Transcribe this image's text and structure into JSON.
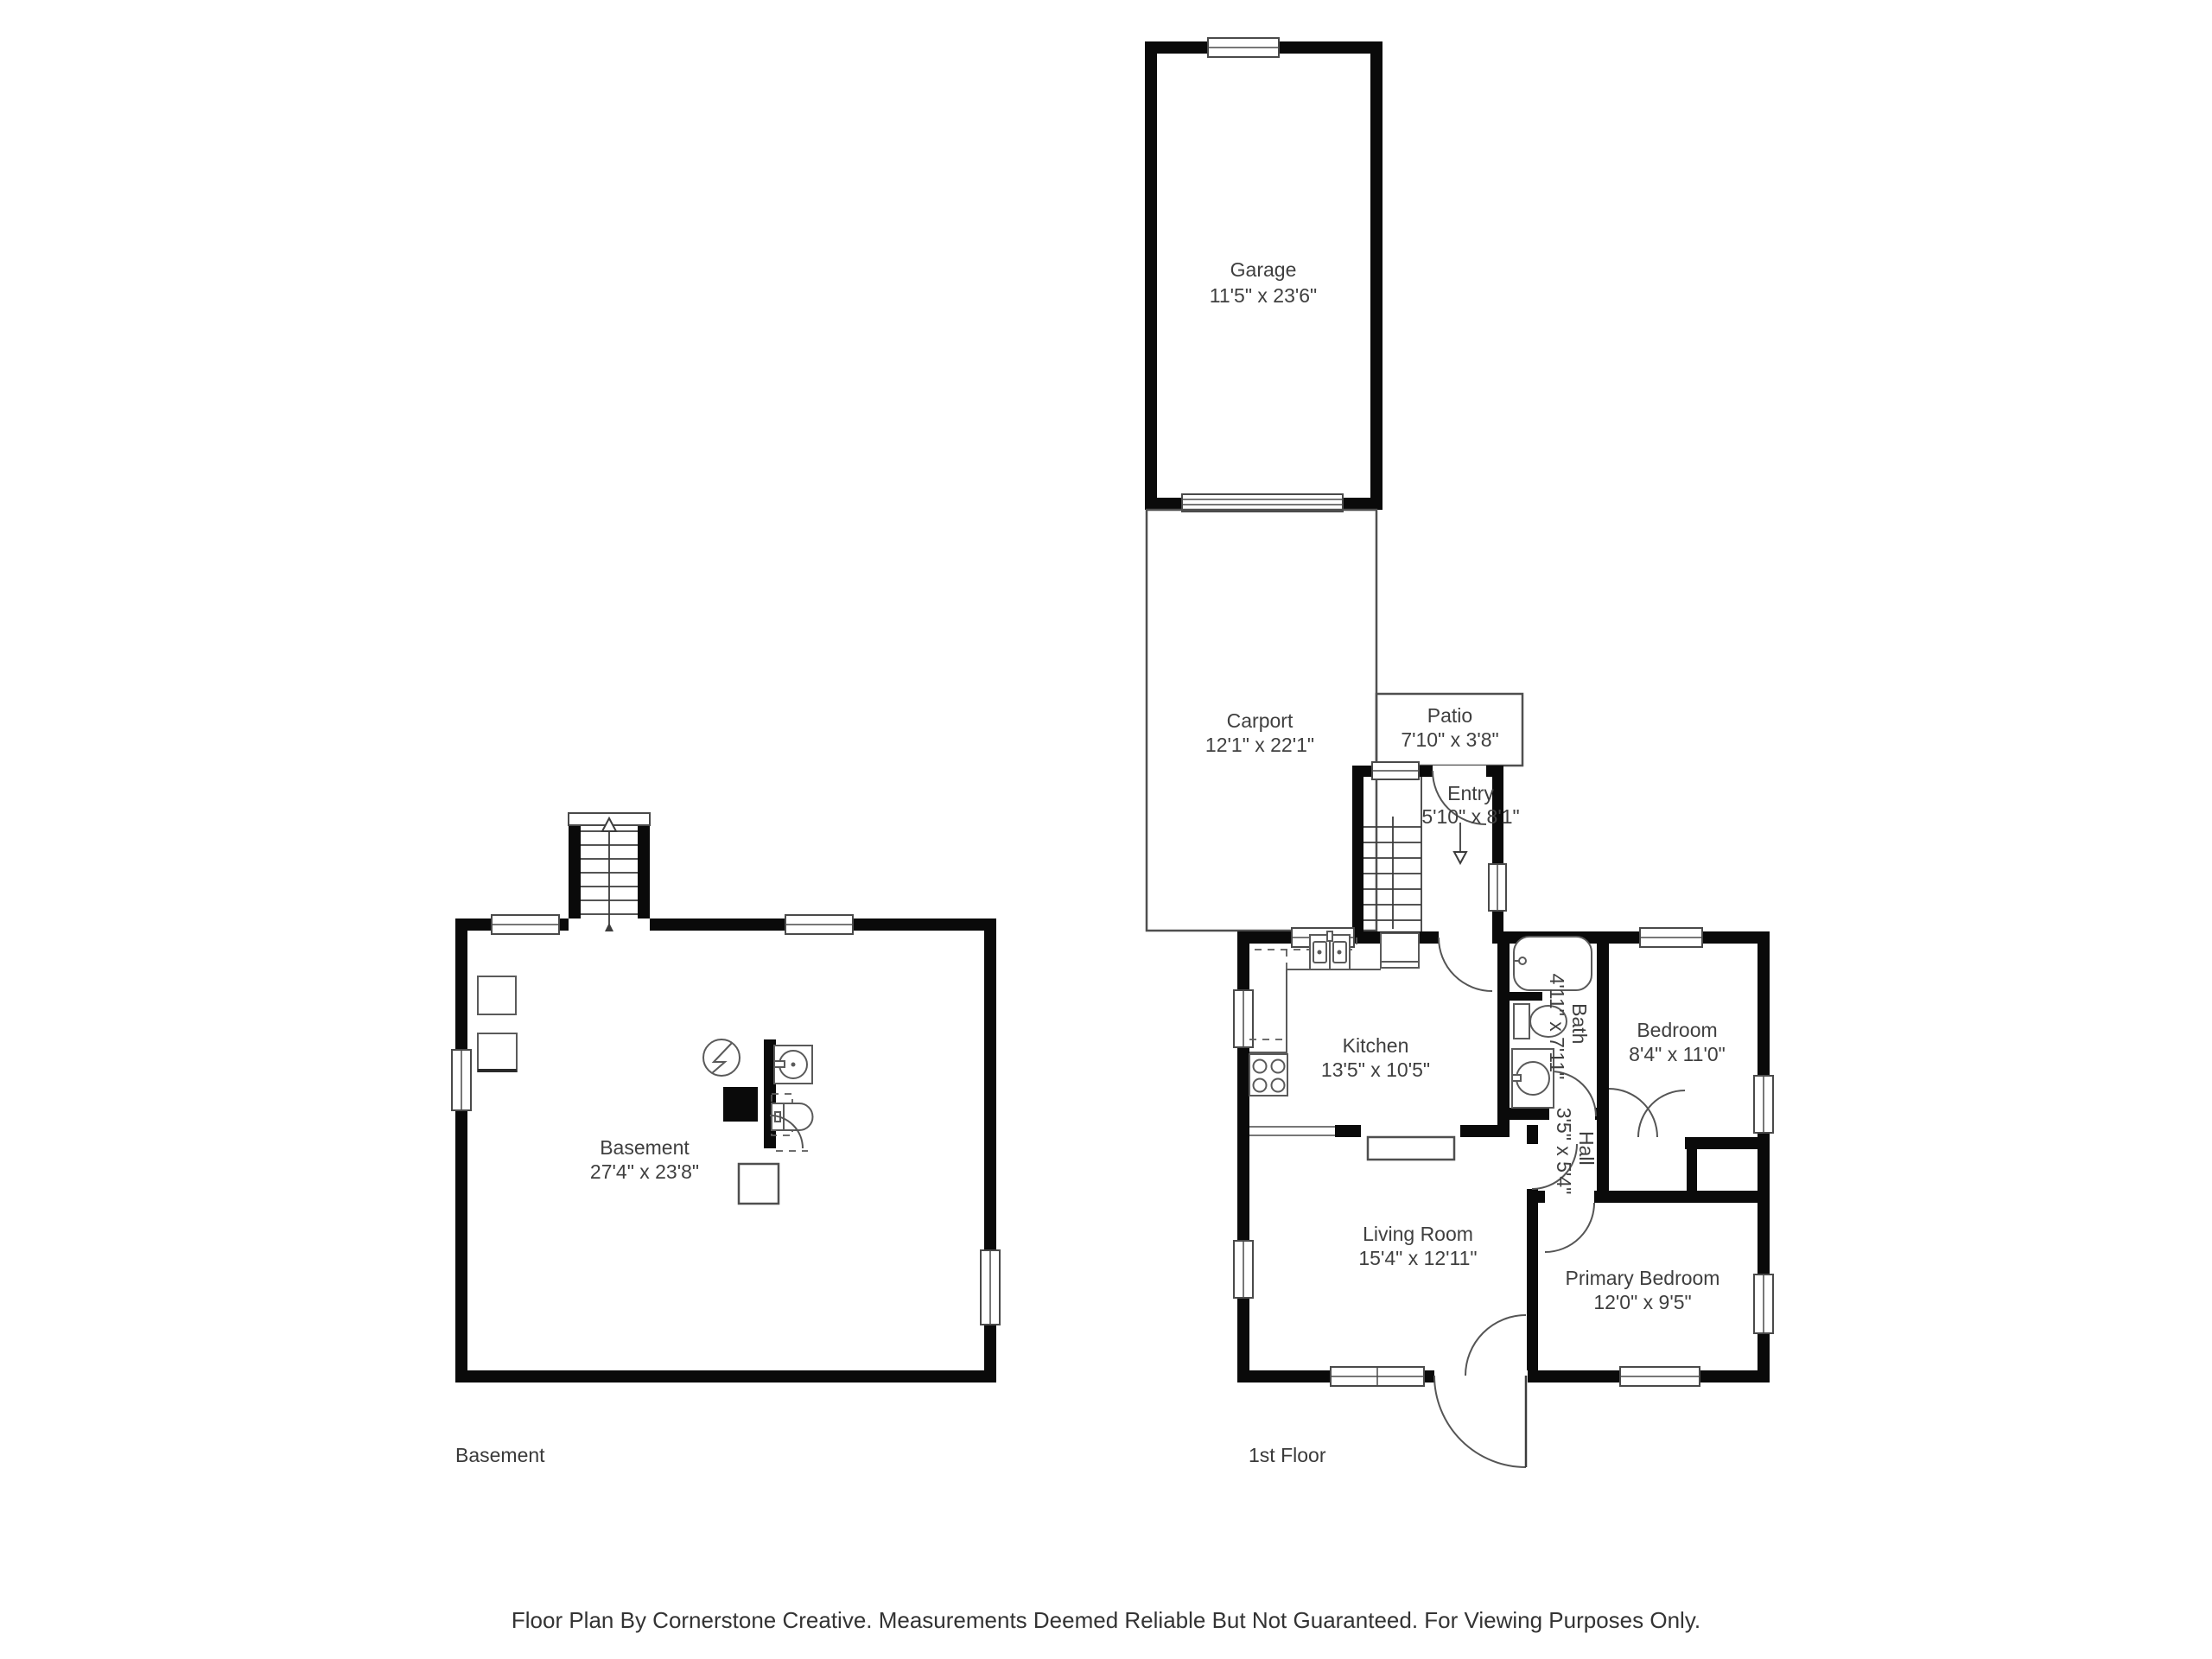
{
  "rooms": {
    "garage": {
      "name": "Garage",
      "dims": "11'5\" x 23'6\""
    },
    "carport": {
      "name": "Carport",
      "dims": "12'1\" x 22'1\""
    },
    "patio": {
      "name": "Patio",
      "dims": "7'10\" x 3'8\""
    },
    "entry": {
      "name": "Entry",
      "dims": "5'10\" x 8'1\""
    },
    "kitchen": {
      "name": "Kitchen",
      "dims": "13'5\" x 10'5\""
    },
    "bath": {
      "name": "Bath",
      "dims": "4'11\" x 7'11\""
    },
    "bedroom": {
      "name": "Bedroom",
      "dims": "8'4\" x 11'0\""
    },
    "hall": {
      "name": "Hall",
      "dims": "3'5\" x 5'4\""
    },
    "living_room": {
      "name": "Living Room",
      "dims": "15'4\" x 12'11\""
    },
    "primary_bedroom": {
      "name": "Primary Bedroom",
      "dims": "12'0\" x 9'5\""
    },
    "basement": {
      "name": "Basement",
      "dims": "27'4\" x 23'8\""
    }
  },
  "floor_labels": {
    "basement": "Basement",
    "first": "1st Floor"
  },
  "footer": {
    "text": "Floor Plan By Cornerstone Creative. Measurements Deemed Reliable But Not Guaranteed. For Viewing Purposes Only."
  },
  "colors": {
    "wall": "#0a0a0a",
    "line": "#4f4f4f",
    "text": "#3f3f3f"
  }
}
